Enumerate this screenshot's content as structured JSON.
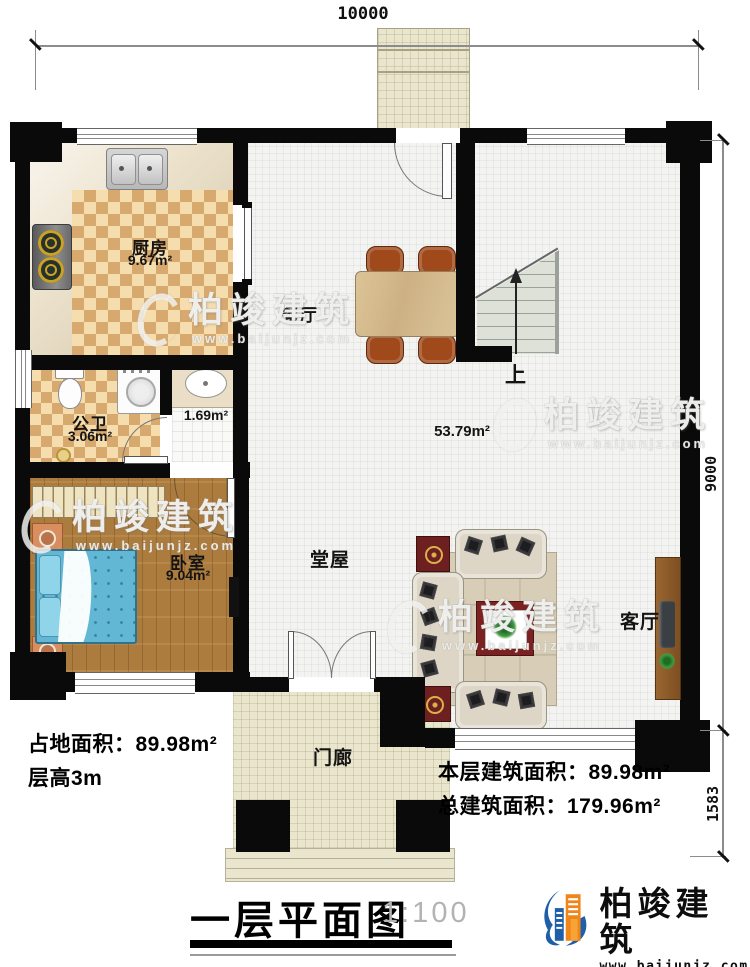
{
  "plan": {
    "rooms": {
      "kitchen": {
        "name": "厨房",
        "area": "9.67m²"
      },
      "dining": {
        "name": "餐厅"
      },
      "bathroom": {
        "name": "公卫",
        "area": "3.06m²"
      },
      "washroom": {
        "area": "1.69m²"
      },
      "open_space": {
        "area": "53.79m²"
      },
      "bedroom": {
        "name": "卧室",
        "area": "9.04m²"
      },
      "hall": {
        "name": "堂屋"
      },
      "living_room": {
        "name": "客厅"
      },
      "porch": {
        "name": "门廊"
      },
      "stairs": {
        "up_label": "上"
      }
    },
    "dimensions": {
      "width_top": "10000",
      "height_right": "9000",
      "porch_depth_right": "1583"
    }
  },
  "notes": {
    "left_line1": "占地面积：89.98m²",
    "left_line2": "层高3m",
    "right_line1": "本层建筑面积：89.98m²",
    "right_line2": "总建筑面积：179.96m²"
  },
  "title_block": {
    "title": "一层平面图",
    "scale": "1:100"
  },
  "brand": {
    "name": "柏竣建筑",
    "website": "www.baijunjz.com"
  },
  "watermark": {
    "name": "柏竣建筑",
    "website": "www.baijunjz.com"
  },
  "colors": {
    "wall": "#0a0a0a",
    "checker_dark": "#d7a96f",
    "checker_light": "#f6ddae",
    "wood_floor": "#ac7c3e",
    "bed_blue": "#62b8d4",
    "brand_blue": "#1e5fa8",
    "brand_orange": "#f08519"
  }
}
